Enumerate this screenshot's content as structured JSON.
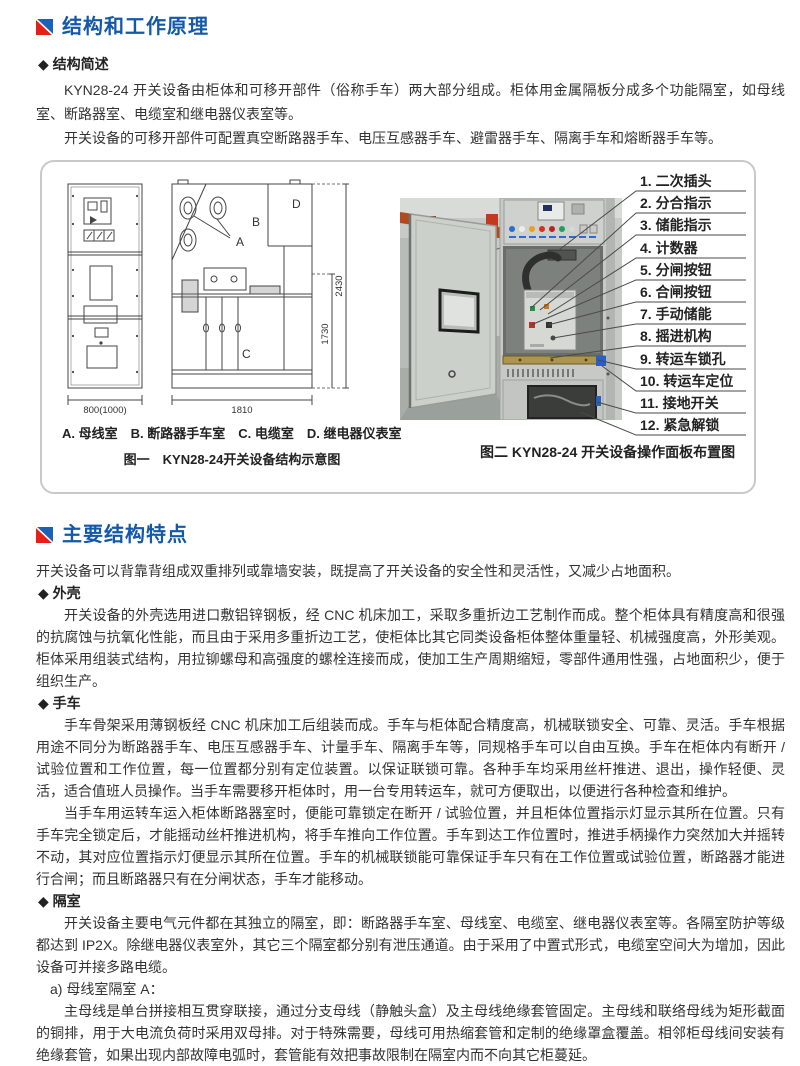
{
  "colors": {
    "header_blue": "#1458a8",
    "icon_red": "#e62019",
    "icon_blue": "#1b62b5",
    "figure_border": "#c9c9c9",
    "body_text": "#333333"
  },
  "section1": {
    "title": "结构和工作原理",
    "bullet_overview": "◆ 结构简述",
    "para1": "KYN28-24 开关设备由柜体和可移开部件（俗称手车）两大部分组成。柜体用金属隔板分成多个功能隔室，如母线室、断路器室、电缆室和继电器仪表室等。",
    "para2": "开关设备的可移开部件可配置真空断路器手车、电压互感器手车、避雷器手车、隔离手车和熔断器手车等。"
  },
  "figure1": {
    "labels": {
      "A": "A",
      "B": "B",
      "C": "C",
      "D": "D",
      "dim_front": "800(1000)",
      "dim_width": "1810",
      "dim_h_outer": "2430",
      "dim_h_inner": "1730"
    },
    "rooms": "A. 母线室　B. 断路器手车室　C. 电缆室　D. 继电器仪表室",
    "caption": "图一　KYN28-24开关设备结构示意图"
  },
  "figure2": {
    "callouts": [
      "1. 二次插头",
      "2. 分合指示",
      "3. 储能指示",
      "4. 计数器",
      "5. 分闸按钮",
      "6. 合闸按钮",
      "7. 手动储能",
      "8. 摇进机构",
      "9. 转运车锁孔",
      "10. 转运车定位",
      "11. 接地开关",
      "12. 紧急解锁"
    ],
    "caption": "图二 KYN28-24 开关设备操作面板布置图"
  },
  "section2": {
    "title": "主要结构特点",
    "intro": "开关设备可以背靠背组成双重排列或靠墙安装，既提高了开关设备的安全性和灵活性，又减少占地面积。",
    "bullet_shell": "◆ 外壳",
    "shell_para": "开关设备的外壳选用进口敷铝锌钢板，经 CNC 机床加工，采取多重折边工艺制作而成。整个柜体具有精度高和很强的抗腐蚀与抗氧化性能，而且由于采用多重折边工艺，使柜体比其它同类设备柜体整体重量轻、机械强度高，外形美观。柜体采用组装式结构，用拉铆螺母和高强度的螺栓连接而成，使加工生产周期缩短，零部件通用性强，占地面积少，便于组织生产。",
    "bullet_trolley": "◆ 手车",
    "trolley_para1": "手车骨架采用薄钢板经 CNC 机床加工后组装而成。手车与柜体配合精度高，机械联锁安全、可靠、灵活。手车根据用途不同分为断路器手车、电压互感器手车、计量手车、隔离手车等，同规格手车可以自由互换。手车在柜体内有断开 / 试验位置和工作位置，每一位置都分别有定位装置。以保证联锁可靠。各种手车均采用丝杆推进、退出，操作轻便、灵活，适合值班人员操作。当手车需要移开柜体时，用一台专用转运车，就可方便取出，以便进行各种检查和维护。",
    "trolley_para2": "当手车用运转车运入柜体断路器室时，便能可靠锁定在断开 / 试验位置，并且柜体位置指示灯显示其所在位置。只有手车完全锁定后，才能摇动丝杆推进机构，将手车推向工作位置。手车到达工作位置时，推进手柄操作力突然加大并摇转不动，其对应位置指示灯便显示其所在位置。手车的机械联锁能可靠保证手车只有在工作位置或试验位置，断路器才能进行合闸；而且断路器只有在分闸状态，手车才能移动。",
    "bullet_compartment": "◆ 隔室",
    "compartment_para": "开关设备主要电气元件都在其独立的隔室，即：断路器手车室、母线室、电缆室、继电器仪表室等。各隔室防护等级都达到 IP2X。除继电器仪表室外，其它三个隔室都分别有泄压通道。由于采用了中置式形式，电缆室空间大为增加，因此设备可并接多路电缆。",
    "sub_a_title": "a) 母线室隔室 A：",
    "sub_a_para": "主母线是单台拼接相互贯穿联接，通过分支母线（静触头盒）及主母线绝缘套管固定。主母线和联络母线为矩形截面的铜排，用于大电流负荷时采用双母排。对于特殊需要，母线可用热缩套管和定制的绝缘罩盒覆盖。相邻柜母线间安装有绝缘套管，如果出现内部故障电弧时，套管能有效把事故限制在隔室内而不向其它柜蔓延。"
  }
}
